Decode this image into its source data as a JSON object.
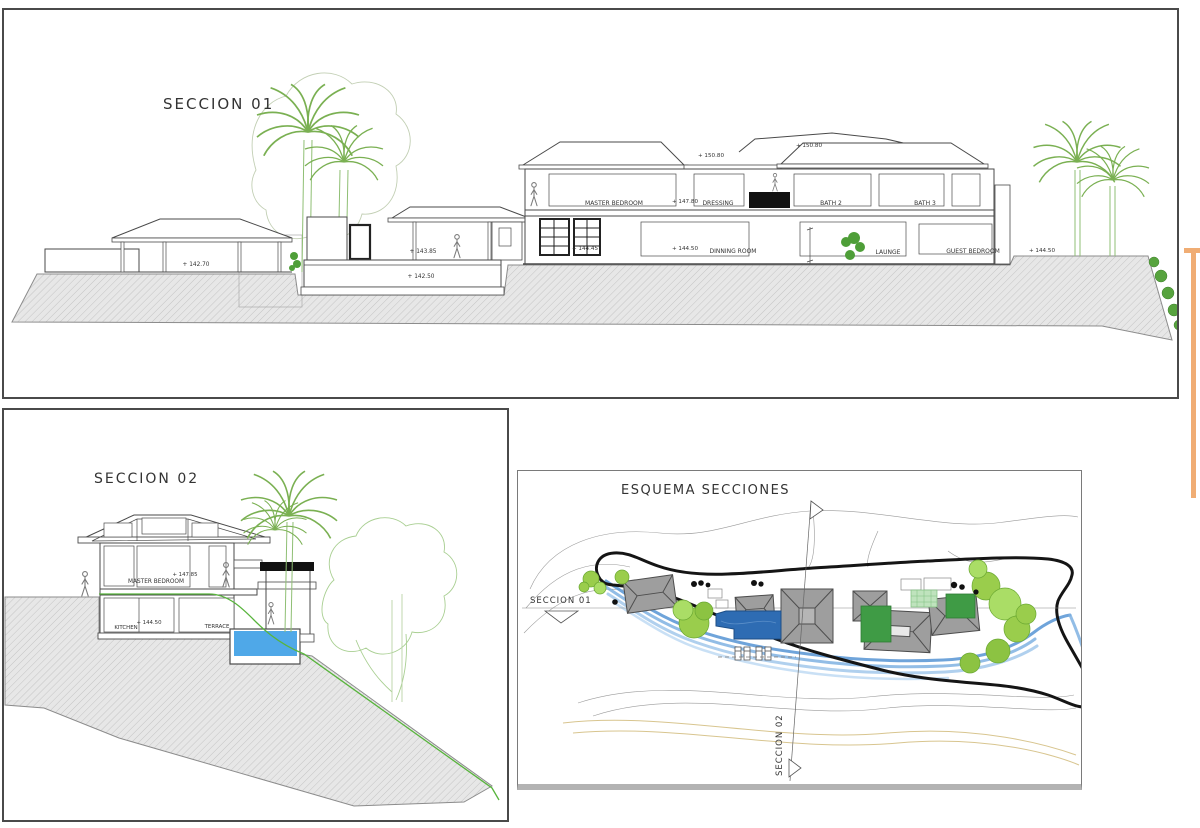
{
  "colors": {
    "line": "#4a4a4a",
    "ground_fill": "#e7e7e7",
    "ground_hatch": "#c4c4c4",
    "palm_green": "#7ab052",
    "tree_light_green": "#9acd4c",
    "lawn_green": "#3f9b45",
    "pool_section_blue": "#4fa8e8",
    "pool_plan_blue": "#2e6cb3",
    "stream_blue": "#7fb2e2",
    "boundary_black": "#151515",
    "contour_tan": "#d8c58f",
    "accent_orange": "#f0ad74"
  },
  "panels": {
    "seccion01": {
      "title": "SECCION 01",
      "rooms": {
        "master_bedroom": "MASTER BEDROOM",
        "dressing": "DRESSING",
        "bath2": "BATH 2",
        "bath3": "BATH 3",
        "dinning_room": "DINNING ROOM",
        "launge": "LAUNGE",
        "guest_bedroom": "GUEST BEDROOM"
      },
      "elevations": {
        "e14270": "+ 142.70",
        "e14385": "+ 143.85",
        "e14250": "+ 142.50",
        "e14445": "+ 144.45",
        "e14780": "+ 147.80",
        "e15080a": "+ 150.80",
        "e15080b": "+ 150.80",
        "e14450a": "+ 144.50",
        "e14450b": "+ 144.50"
      }
    },
    "seccion02": {
      "title": "SECCION 02",
      "rooms": {
        "master_bedroom": "MASTER BEDROOM",
        "kitchen": "KITCHEN",
        "terrace": "TERRACE"
      },
      "elevations": {
        "e14785": "+ 147.85",
        "e14450": "+ 144.50"
      }
    },
    "esquema": {
      "title": "ESQUEMA SECCIONES",
      "marker_seccion01": "SECCION 01",
      "marker_seccion02": "SECCION 02"
    }
  }
}
